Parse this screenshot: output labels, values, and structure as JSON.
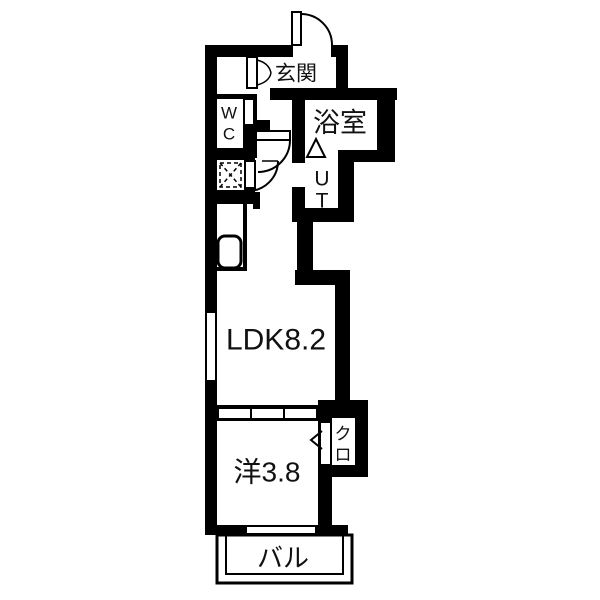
{
  "colors": {
    "wall": "#000000",
    "bg": "#ffffff",
    "line": "#000000",
    "text": "#111111"
  },
  "rooms": {
    "genkan": {
      "label": "玄関"
    },
    "wc": {
      "line1": "W",
      "line2": "C"
    },
    "bath": {
      "label": "浴室"
    },
    "ut": {
      "line1": "U",
      "line2": "T"
    },
    "ldk": {
      "label": "LDK8.2"
    },
    "western": {
      "label": "洋3.8"
    },
    "closet": {
      "line1": "ク",
      "line2": "ロ"
    },
    "balcony": {
      "label": "バル"
    }
  }
}
